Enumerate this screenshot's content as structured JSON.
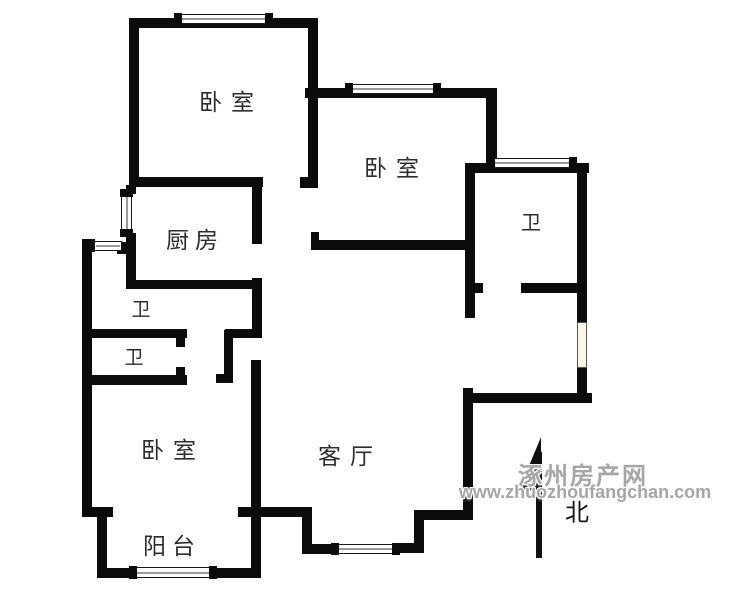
{
  "page": {
    "background": "#ffffff",
    "wall_color": "#0b0b0b"
  },
  "watermark": {
    "line1": "涿州房产网",
    "line2": "www.zhuozhoufangchan.com",
    "color": "#a6a6a6"
  },
  "compass": {
    "label": "北"
  },
  "rooms": [
    {
      "id": "bedroom-top-left",
      "label": "卧室",
      "cx": 231,
      "cy": 100,
      "fs": 23,
      "ls": 9
    },
    {
      "id": "bedroom-middle",
      "label": "卧室",
      "cx": 396,
      "cy": 166,
      "fs": 23,
      "ls": 9
    },
    {
      "id": "bath-top-right",
      "label": "卫",
      "cx": 531,
      "cy": 221,
      "fs": 20,
      "ls": 0
    },
    {
      "id": "kitchen",
      "label": "厨房",
      "cx": 195,
      "cy": 238,
      "fs": 23,
      "ls": 6
    },
    {
      "id": "bath-upper-left",
      "label": "卫",
      "cx": 141,
      "cy": 308,
      "fs": 19,
      "ls": 0
    },
    {
      "id": "bath-lower-left",
      "label": "卫",
      "cx": 134,
      "cy": 356,
      "fs": 19,
      "ls": 0
    },
    {
      "id": "bedroom-bottom-left",
      "label": "卧室",
      "cx": 173,
      "cy": 448,
      "fs": 23,
      "ls": 9
    },
    {
      "id": "living-room",
      "label": "客厅",
      "cx": 350,
      "cy": 454,
      "fs": 23,
      "ls": 9
    },
    {
      "id": "balcony",
      "label": "阳台",
      "cx": 172,
      "cy": 544,
      "fs": 23,
      "ls": 6
    }
  ],
  "floorplan": {
    "walls": [
      [
        129,
        18,
        189,
        10
      ],
      [
        129,
        18,
        10,
        169
      ],
      [
        308,
        18,
        10,
        170
      ],
      [
        300,
        177,
        9,
        11
      ],
      [
        305,
        88,
        192,
        10
      ],
      [
        486,
        88,
        11,
        85
      ],
      [
        465,
        163,
        124,
        10
      ],
      [
        465,
        163,
        10,
        155
      ],
      [
        473,
        283,
        10,
        10
      ],
      [
        521,
        283,
        66,
        10
      ],
      [
        577,
        163,
        10,
        159
      ],
      [
        577,
        368,
        10,
        35
      ],
      [
        463,
        393,
        129,
        10
      ],
      [
        133,
        177,
        130,
        10
      ],
      [
        252,
        177,
        10,
        67
      ],
      [
        252,
        278,
        10,
        60
      ],
      [
        126,
        185,
        10,
        9
      ],
      [
        126,
        233,
        10,
        56
      ],
      [
        129,
        280,
        129,
        9
      ],
      [
        311,
        240,
        154,
        10
      ],
      [
        311,
        232,
        8,
        10
      ],
      [
        82,
        239,
        13,
        13
      ],
      [
        117,
        242,
        14,
        12
      ],
      [
        82,
        244,
        10,
        273
      ],
      [
        83,
        329,
        104,
        9
      ],
      [
        176,
        338,
        9,
        9
      ],
      [
        225,
        329,
        33,
        9
      ],
      [
        224,
        330,
        9,
        53
      ],
      [
        216,
        374,
        17,
        9
      ],
      [
        83,
        375,
        104,
        10
      ],
      [
        176,
        367,
        9,
        8
      ],
      [
        251,
        360,
        10,
        218
      ],
      [
        82,
        507,
        31,
        10
      ],
      [
        97,
        507,
        10,
        71
      ],
      [
        238,
        507,
        72,
        10
      ],
      [
        97,
        568,
        33,
        10
      ],
      [
        215,
        568,
        42,
        10
      ],
      [
        302,
        507,
        10,
        41
      ],
      [
        302,
        544,
        33,
        10
      ],
      [
        398,
        543,
        26,
        10
      ],
      [
        414,
        512,
        10,
        41
      ],
      [
        414,
        510,
        59,
        10
      ],
      [
        463,
        388,
        10,
        132
      ]
    ],
    "windows": [
      {
        "x": 174,
        "y": 14,
        "w": 99,
        "h": 10,
        "dir": "h",
        "caps": [
          1,
          1
        ]
      },
      {
        "x": 345,
        "y": 84,
        "w": 96,
        "h": 10,
        "dir": "h",
        "caps": [
          1,
          1
        ]
      },
      {
        "x": 487,
        "y": 158,
        "w": 90,
        "h": 10,
        "dir": "h",
        "caps": [
          1,
          1
        ]
      },
      {
        "x": 121,
        "y": 189,
        "w": 11,
        "h": 48,
        "dir": "v",
        "caps": [
          1,
          1
        ]
      },
      {
        "x": 94,
        "y": 241,
        "w": 28,
        "h": 10,
        "dir": "h",
        "caps": [
          0,
          0
        ]
      },
      {
        "x": 129,
        "y": 567,
        "w": 88,
        "h": 11,
        "dir": "h",
        "caps": [
          1,
          1
        ]
      },
      {
        "x": 331,
        "y": 544,
        "w": 69,
        "h": 10,
        "dir": "h",
        "caps": [
          1,
          1
        ]
      },
      {
        "x": 577,
        "y": 322,
        "w": 10,
        "h": 46,
        "dir": "v",
        "caps": [
          0,
          0
        ],
        "fill": "#fbf6e6"
      }
    ],
    "north_arrow": {
      "triangle": "541,437 541,490 519,490",
      "shaft": {
        "x": 536,
        "y": 452,
        "w": 6,
        "h": 106
      }
    }
  }
}
